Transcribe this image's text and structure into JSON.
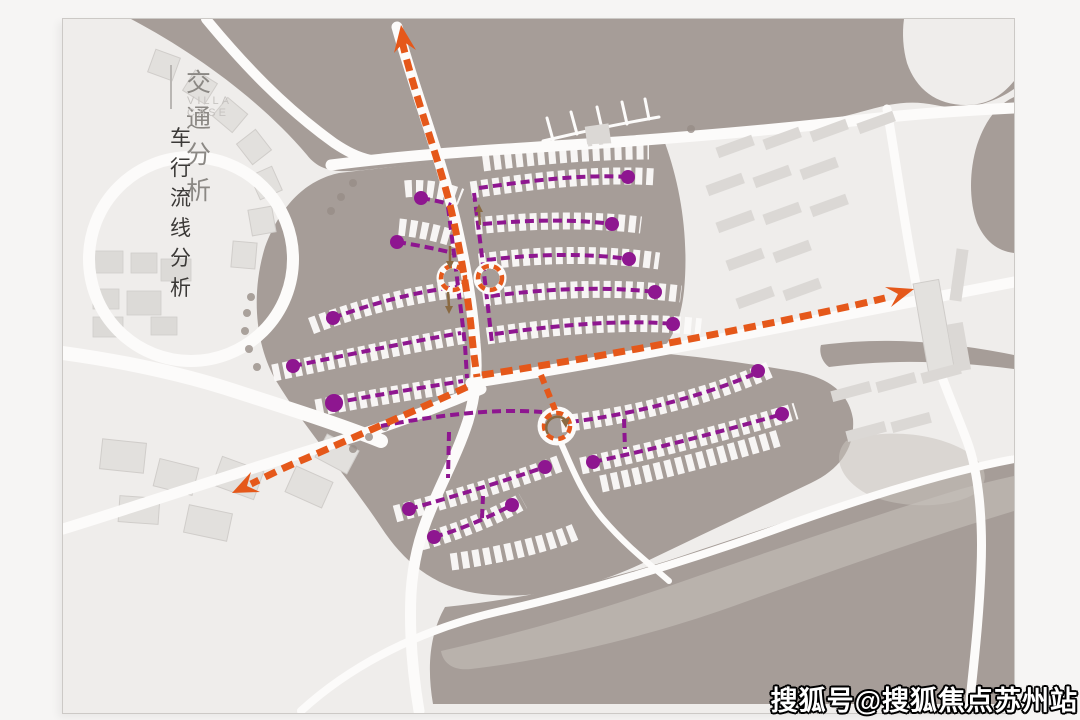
{
  "page": {
    "title": "交通分析",
    "subtitle": "VILLA CASE",
    "section": "车行流线分析",
    "watermark": "搜狐号@搜狐焦点苏州站"
  },
  "colors": {
    "page_bg": "#f6f5f4",
    "board_bg": "#ffffff",
    "map_base": "#efedeb",
    "land": "#a69d98",
    "road": "#fcfbfa",
    "building_light": "#e2e0dd",
    "building_bar": "#dbd8d5",
    "primary_flow": "#e5581a",
    "secondary_flow": "#8e1690",
    "turn_arrow": "#8a6a42",
    "sand": "#c9c3be",
    "title_gray": "#8b8884",
    "subtitle_gray": "#c6c3c0",
    "section_dark": "#3b3937"
  },
  "map": {
    "primary_flow_arrows": [
      "north",
      "east",
      "southwest"
    ],
    "secondary_flow_endpoints": 17,
    "roundabouts": 3
  }
}
